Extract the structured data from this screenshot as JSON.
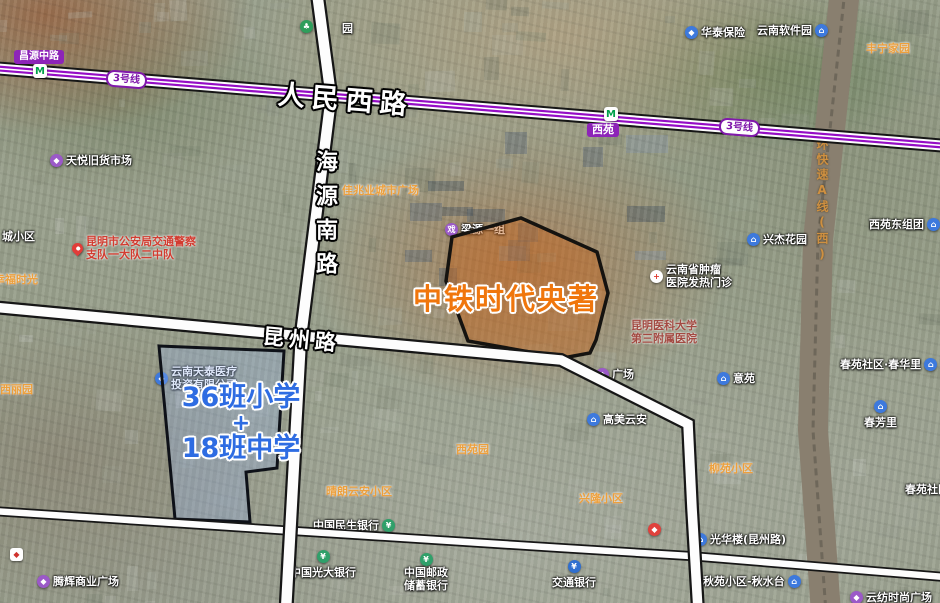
{
  "map_annotations": {
    "roads": {
      "renmin_west": "人民西路",
      "haiyuan_south": "海源南路",
      "kunzhou": "昆州路",
      "changyuan_middle": "昌源中路"
    },
    "metro": {
      "line_badge": "3号线",
      "station_xiyuan": "西苑"
    },
    "railway_label": "环快速A线(西)",
    "project_label": "中铁时代央著",
    "school_label": {
      "line1": "36班小学",
      "plus": "+",
      "line2": "18班中学"
    }
  },
  "colors": {
    "metro_purple": "#950dc5",
    "road_fill": "#fdfdfd",
    "road_casing": "#161616",
    "project_text": "#f0760c",
    "project_plot_fill": "rgba(196,104,34,0.47)",
    "school_text": "#2e6ce2",
    "school_plot_fill": "rgba(150,178,238,0.30)",
    "poi_orange": "#eda03c"
  },
  "pois": [
    {
      "name": "poi-park-fragment-gao",
      "label": "高",
      "icon": "park",
      "x": 300,
      "y": 18
    },
    {
      "name": "poi-park-fragment-yuan",
      "label": "园",
      "x": 342,
      "y": 20
    },
    {
      "name": "poi-tianyue-secondhand-market",
      "label": "天悦旧货市场",
      "icon": "shopping",
      "x": 50,
      "y": 152
    },
    {
      "name": "poi-huatai-insurance",
      "label": "华泰保险",
      "icon": "company",
      "x": 685,
      "y": 24
    },
    {
      "name": "poi-yunnan-software-park",
      "label": "云南软件园",
      "icon": "residential",
      "icon_side": "right",
      "x": 757,
      "y": 22
    },
    {
      "name": "poi-fengning-homeland",
      "label": "丰宁家园",
      "style": "orange",
      "x": 866,
      "y": 40
    },
    {
      "name": "poi-xiyuan-east-block",
      "label": "西苑东组团",
      "icon": "residential",
      "icon_side": "right",
      "x": 869,
      "y": 216
    },
    {
      "name": "poi-xingjie-garden",
      "label": "兴杰花园",
      "icon": "residential",
      "x": 747,
      "y": 231
    },
    {
      "name": "poi-cancer-hospital-fever-clinic",
      "lines": [
        "云南省肿瘤",
        "医院发热门诊"
      ],
      "icon": "hospital",
      "x": 650,
      "y": 264
    },
    {
      "name": "poi-kunming-medical-univ-third-hospital",
      "lines": [
        "昆明医科大学",
        "第三附属医院"
      ],
      "style": "red-dark",
      "x": 631,
      "y": 320
    },
    {
      "name": "poi-traffic-police-detachment",
      "lines": [
        "昆明市公安局交通警察",
        "支队一大队二中队"
      ],
      "style": "red",
      "icon": "pin",
      "x": 72,
      "y": 236
    },
    {
      "name": "poi-cheng-community-partial",
      "label": "城小区",
      "x": 2,
      "y": 228
    },
    {
      "name": "poi-xingfu-shiguang",
      "label": "幸福时光",
      "style": "orange",
      "x": -6,
      "y": 271
    },
    {
      "name": "poi-kaisa-city-plaza",
      "label": "佳兆业城市广场",
      "style": "orange",
      "x": 342,
      "y": 182
    },
    {
      "name": "poi-liangyuan-block-one",
      "label": "梁源一组",
      "icon": "theater",
      "x": 445,
      "y": 221
    },
    {
      "name": "poi-xili-garden",
      "label": "西丽园",
      "style": "orange",
      "x": 0,
      "y": 381
    },
    {
      "name": "poi-yunnan-medical-investment-co",
      "lines": [
        "云南天泰医疗",
        "投资有限公司"
      ],
      "icon": "company",
      "x": 155,
      "y": 366
    },
    {
      "name": "poi-xiyuan-garden",
      "label": "西苑园",
      "style": "orange",
      "x": 456,
      "y": 441
    },
    {
      "name": "poi-qinglang-yunan-community",
      "label": "晴朗云安小区",
      "style": "orange",
      "x": 326,
      "y": 483
    },
    {
      "name": "poi-gaomei-yunan",
      "label": "高美云安",
      "icon": "residential",
      "x": 587,
      "y": 411
    },
    {
      "name": "poi-yiyuan",
      "label": "意苑",
      "icon": "residential",
      "x": 717,
      "y": 370
    },
    {
      "name": "poi-plaza-partial",
      "label": "广场",
      "icon": "shopping",
      "x": 596,
      "y": 366
    },
    {
      "name": "poi-liuyuan-community",
      "label": "柳苑小区",
      "style": "orange",
      "x": 709,
      "y": 460
    },
    {
      "name": "poi-xinglong-community",
      "label": "兴隆小区",
      "style": "orange",
      "x": 579,
      "y": 490
    },
    {
      "name": "poi-chunyuan-chunhuali",
      "label": "春苑社区·春华里",
      "icon": "residential",
      "icon_side": "right",
      "x": 840,
      "y": 356
    },
    {
      "name": "poi-chunfangli",
      "label": "春芳里",
      "icon": "residential",
      "icon_pos": "above",
      "x": 864,
      "y": 400
    },
    {
      "name": "poi-chunyuan-community-partial",
      "label": "春苑社区",
      "x": 905,
      "y": 481
    },
    {
      "name": "poi-minsheng-bank",
      "label": "中国民生银行",
      "icon": "bank",
      "icon_side": "right",
      "x": 313,
      "y": 517
    },
    {
      "name": "poi-everbright-bank",
      "label": "中国光大银行",
      "icon": "bank",
      "icon_pos": "above",
      "x": 290,
      "y": 550
    },
    {
      "name": "poi-psbc-bank",
      "lines": [
        "中国邮政",
        "储蓄银行"
      ],
      "icon": "bank",
      "icon_pos": "above",
      "x": 404,
      "y": 553
    },
    {
      "name": "poi-bocom-bank",
      "label": "交通银行",
      "icon": "bank-blue",
      "icon_pos": "above",
      "x": 552,
      "y": 560
    },
    {
      "name": "poi-guanghua-building",
      "label": "光华楼(昆州路)",
      "icon": "residential",
      "x": 694,
      "y": 531
    },
    {
      "name": "poi-qiuyuan-qiushuitai",
      "label": "秋苑小区-秋水台",
      "icon": "residential",
      "icon_side": "right",
      "x": 703,
      "y": 573
    },
    {
      "name": "poi-yunfang-fashion-plaza",
      "label": "云纺时尚广场",
      "icon": "shopping",
      "x": 850,
      "y": 589
    },
    {
      "name": "poi-tenghui-commercial-plaza",
      "label": "腾辉商业广场",
      "icon": "shopping",
      "x": 37,
      "y": 573
    },
    {
      "name": "poi-brand-badge",
      "label": "",
      "icon": "logo",
      "x": 10,
      "y": 548
    },
    {
      "name": "poi-red-badge",
      "label": "",
      "icon": "logo-red",
      "x": 648,
      "y": 523
    }
  ]
}
